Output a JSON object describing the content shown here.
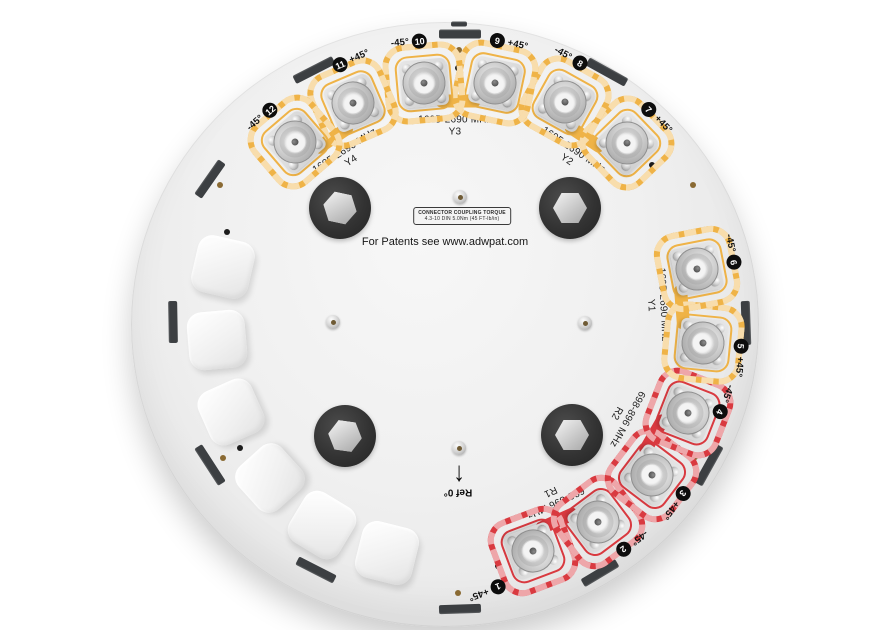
{
  "colors": {
    "yellow": "#EFB347",
    "red": "#D93A40",
    "tick": "#3C3F42",
    "dot_black": "#1C1C1C",
    "dot_bronze": "#8A6A33",
    "badge_bg": "#0D0D0D",
    "badge_text": "#FFFFFF",
    "plate": "#EDEDED",
    "background": "#FFFFFF"
  },
  "center": {
    "patents": "For Patents see www.adwpat.com",
    "torque_line1": "CONNECTOR COUPLING TORQUE",
    "torque_line2": "4.3-10 DIN  5.0Nm (45 FT-lb/in)",
    "ref_label": "Ref 0°",
    "ref_arrow": "↓"
  },
  "ports": [
    {
      "num": "1",
      "pol": "+45°",
      "color": "red",
      "x": 533,
      "y": 551,
      "rot": 159.3,
      "lx": 487,
      "ly": 591
    },
    {
      "num": "2",
      "pol": "-45°",
      "color": "red",
      "x": 598,
      "y": 522,
      "rot": 143.1,
      "lx": 632,
      "ly": 543
    },
    {
      "num": "3",
      "pol": "+45°",
      "color": "red",
      "x": 652,
      "y": 475,
      "rot": 127.2,
      "lx": 676,
      "ly": 503
    },
    {
      "num": "4",
      "pol": "-45°",
      "color": "red",
      "x": 688,
      "y": 413,
      "rot": 111.4,
      "lx": 724,
      "ly": 402
    },
    {
      "num": "5",
      "pol": "+45°",
      "color": "yellow",
      "x": 703,
      "y": 343,
      "rot": 95.5,
      "lx": 740,
      "ly": 358
    },
    {
      "num": "6",
      "pol": "-45°",
      "color": "yellow",
      "x": 697,
      "y": 269,
      "rot": 79,
      "lx": 732,
      "ly": 252
    },
    {
      "num": "7",
      "pol": "+45°",
      "color": "yellow",
      "x": 627,
      "y": 143,
      "rot": 46.1,
      "lx": 657,
      "ly": 118
    },
    {
      "num": "8",
      "pol": "-45°",
      "color": "yellow",
      "x": 565,
      "y": 102,
      "rot": 29.1,
      "lx": 571,
      "ly": 58
    },
    {
      "num": "9",
      "pol": "+45°",
      "color": "yellow",
      "x": 495,
      "y": 83,
      "rot": 12,
      "lx": 509,
      "ly": 43
    },
    {
      "num": "10",
      "pol": "-45°",
      "color": "yellow",
      "x": 424,
      "y": 83,
      "rot": -5.1,
      "lx": 409,
      "ly": 42
    },
    {
      "num": "11",
      "pol": "+45°",
      "color": "yellow",
      "x": 353,
      "y": 103,
      "rot": -23.2,
      "lx": 351,
      "ly": 60
    },
    {
      "num": "12",
      "pol": "-45°",
      "color": "yellow",
      "x": 295,
      "y": 142,
      "rot": -40.6,
      "lx": 262,
      "ly": 117
    }
  ],
  "pairs": [
    {
      "id": "Y4",
      "freq": "1695-2690 MHz",
      "color": "yellow",
      "label": {
        "x": 348,
        "y": 156,
        "rot": -33
      },
      "bridge": {
        "x": 333,
        "y": 138,
        "rot": -34
      }
    },
    {
      "id": "Y3",
      "freq": "1695-2690 MHz",
      "color": "yellow",
      "label": {
        "x": 455,
        "y": 126,
        "rot": 0
      },
      "bridge": {
        "x": 458,
        "y": 101,
        "rot": 0
      }
    },
    {
      "id": "Y2",
      "freq": "1695-2690 MHz",
      "color": "yellow",
      "label": {
        "x": 570,
        "y": 155,
        "rot": 34
      },
      "bridge": {
        "x": 585,
        "y": 137,
        "rot": 33.5
      }
    },
    {
      "id": "Y1",
      "freq": "1695-2690 MHz",
      "color": "yellow",
      "label": {
        "x": 657,
        "y": 305,
        "rot": 87
      },
      "bridge": {
        "x": 682,
        "y": 307,
        "rot": 85.4
      }
    },
    {
      "id": "R2",
      "freq": "698-896 MHz",
      "color": "red",
      "label": {
        "x": 622,
        "y": 416,
        "rot": 119
      },
      "bridge": {
        "x": 654,
        "y": 435,
        "rot": 120
      }
    },
    {
      "id": "R1",
      "freq": "698-896 MHz",
      "color": "red",
      "label": {
        "x": 553,
        "y": 497,
        "rot": 155
      },
      "bridge": {
        "x": 557,
        "y": 521,
        "rot": 156
      }
    }
  ],
  "caps": [
    {
      "x": 223,
      "y": 267,
      "rot": 13
    },
    {
      "x": 217,
      "y": 340,
      "rot": -5
    },
    {
      "x": 231,
      "y": 412,
      "rot": -24
    },
    {
      "x": 270,
      "y": 478,
      "rot": -42
    },
    {
      "x": 322,
      "y": 525,
      "rot": 31
    },
    {
      "x": 387,
      "y": 553,
      "rot": 14
    }
  ],
  "ticks": [
    {
      "x": 460,
      "y": 34,
      "rot": 0,
      "w": 42,
      "h": 9
    },
    {
      "x": 459,
      "y": 24,
      "rot": 0,
      "w": 16,
      "h": 5
    },
    {
      "x": 210,
      "y": 179,
      "rot": -55,
      "w": 42,
      "h": 9
    },
    {
      "x": 314,
      "y": 70,
      "rot": -27,
      "w": 44,
      "h": 9
    },
    {
      "x": 607,
      "y": 72,
      "rot": 29,
      "w": 44,
      "h": 9
    },
    {
      "x": 746,
      "y": 323,
      "rot": 88,
      "w": 44,
      "h": 9
    },
    {
      "x": 709,
      "y": 465,
      "rot": 119,
      "w": 44,
      "h": 9
    },
    {
      "x": 600,
      "y": 573,
      "rot": 149,
      "w": 40,
      "h": 9
    },
    {
      "x": 460,
      "y": 609,
      "rot": 178,
      "w": 42,
      "h": 9
    },
    {
      "x": 316,
      "y": 570,
      "rot": 207,
      "w": 42,
      "h": 9
    },
    {
      "x": 210,
      "y": 465,
      "rot": 237,
      "w": 44,
      "h": 9
    },
    {
      "x": 173,
      "y": 322,
      "rot": 269,
      "w": 42,
      "h": 9
    }
  ],
  "mount_holes": [
    {
      "x": 340,
      "y": 208,
      "hrot": 12
    },
    {
      "x": 570,
      "y": 208,
      "hrot": 0
    },
    {
      "x": 345,
      "y": 436,
      "hrot": 8
    },
    {
      "x": 572,
      "y": 435,
      "hrot": 0
    }
  ],
  "screws": [
    {
      "x": 460,
      "y": 197
    },
    {
      "x": 585,
      "y": 323
    },
    {
      "x": 333,
      "y": 322
    },
    {
      "x": 459,
      "y": 448
    }
  ],
  "dots": [
    {
      "x": 458,
      "y": 68,
      "c": "b"
    },
    {
      "x": 459,
      "y": 50,
      "c": "z"
    },
    {
      "x": 652,
      "y": 165,
      "c": "b"
    },
    {
      "x": 693,
      "y": 185,
      "c": "z"
    },
    {
      "x": 678,
      "y": 448,
      "c": "b"
    },
    {
      "x": 695,
      "y": 457,
      "c": "z"
    },
    {
      "x": 498,
      "y": 566,
      "c": "b"
    },
    {
      "x": 458,
      "y": 593,
      "c": "z"
    },
    {
      "x": 240,
      "y": 448,
      "c": "b"
    },
    {
      "x": 223,
      "y": 458,
      "c": "z"
    },
    {
      "x": 227,
      "y": 232,
      "c": "b"
    },
    {
      "x": 220,
      "y": 185,
      "c": "z"
    }
  ]
}
